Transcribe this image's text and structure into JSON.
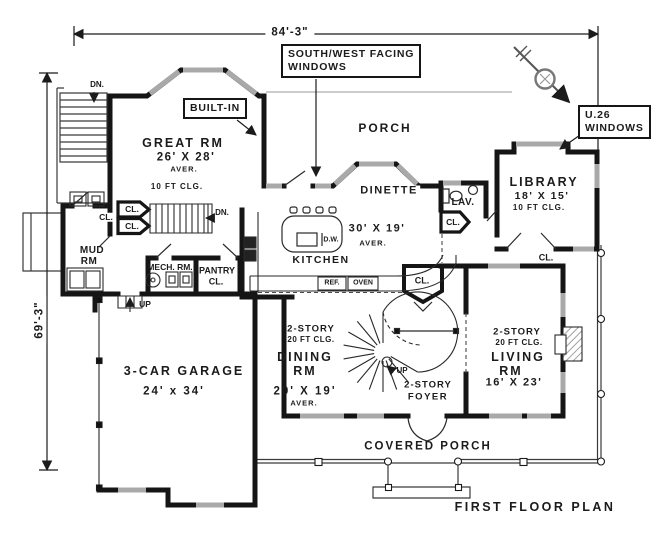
{
  "title": "FIRST FLOOR PLAN",
  "plan": {
    "dim_width": "84'-3\"",
    "dim_height": "69'-3\""
  },
  "callouts": {
    "south_west_1": "SOUTH/WEST FACING",
    "south_west_2": "WINDOWS",
    "built_in": "BUILT-IN",
    "u26_1": "U.26",
    "u26_2": "WINDOWS"
  },
  "rooms": {
    "great": {
      "name": "GREAT RM",
      "size": "26' X 28'"
    },
    "porch": "PORCH",
    "dinette": "DINETTE",
    "lav": "LAV.",
    "library": {
      "name": "LIBRARY",
      "size": "18' X 15'"
    },
    "mud1": "MUD",
    "mud2": "RM",
    "mech": "MECH. RM.",
    "pantry1": "PANTRY",
    "pantry2": "CL.",
    "kitchen": {
      "name": "KITCHEN",
      "size": "30' X 19'"
    },
    "dining": {
      "name": "DINING",
      "size": "20' X 19'"
    },
    "foyer": "FOYER",
    "living": {
      "name": "LIVING",
      "size": "16' X 23'"
    },
    "garage": {
      "name": "3-CAR GARAGE",
      "size": "24' x 34'"
    },
    "covered_porch": "COVERED PORCH"
  },
  "shared": {
    "cl": "CL.",
    "aver": "AVER.",
    "two_story": "2-STORY",
    "clg20": "20 FT CLG.",
    "clg10": "10 FT CLG.",
    "dn": "DN.",
    "up": "UP",
    "rm": "RM"
  },
  "fixtures": {
    "dw": "D.W.",
    "ref": "REF.",
    "oven": "OVEN"
  },
  "colors": {
    "wall": "#151515",
    "window": "#a9a9a9",
    "ink": "#1b1b1b",
    "paper": "#ffffff"
  }
}
